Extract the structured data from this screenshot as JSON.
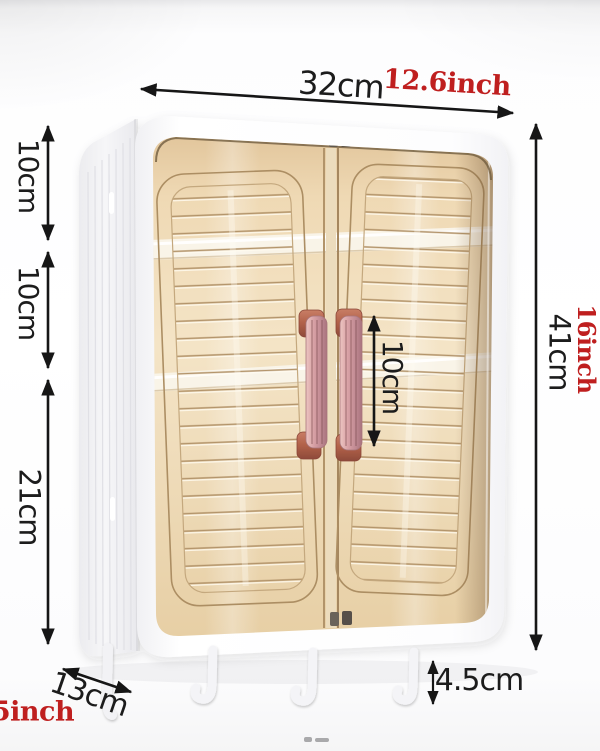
{
  "diagram": {
    "width": {
      "cm": "32cm",
      "inch": "12.6inch"
    },
    "height": {
      "cm": "41cm",
      "inch": "16inch"
    },
    "left_segments": {
      "top": "10cm",
      "middle": "10cm",
      "bottom": "21cm"
    },
    "handle_gap": "10cm",
    "depth": {
      "cm": "13cm",
      "inch": "5inch"
    },
    "hook_drop": "4.5cm",
    "colors": {
      "dimension_text": "#1c1c1c",
      "imperial_accent": "#bf1f1f",
      "door_tint": "#eed6ae",
      "handle_rose": "#cf9a9c",
      "cabinet_white": "#ffffff"
    }
  }
}
